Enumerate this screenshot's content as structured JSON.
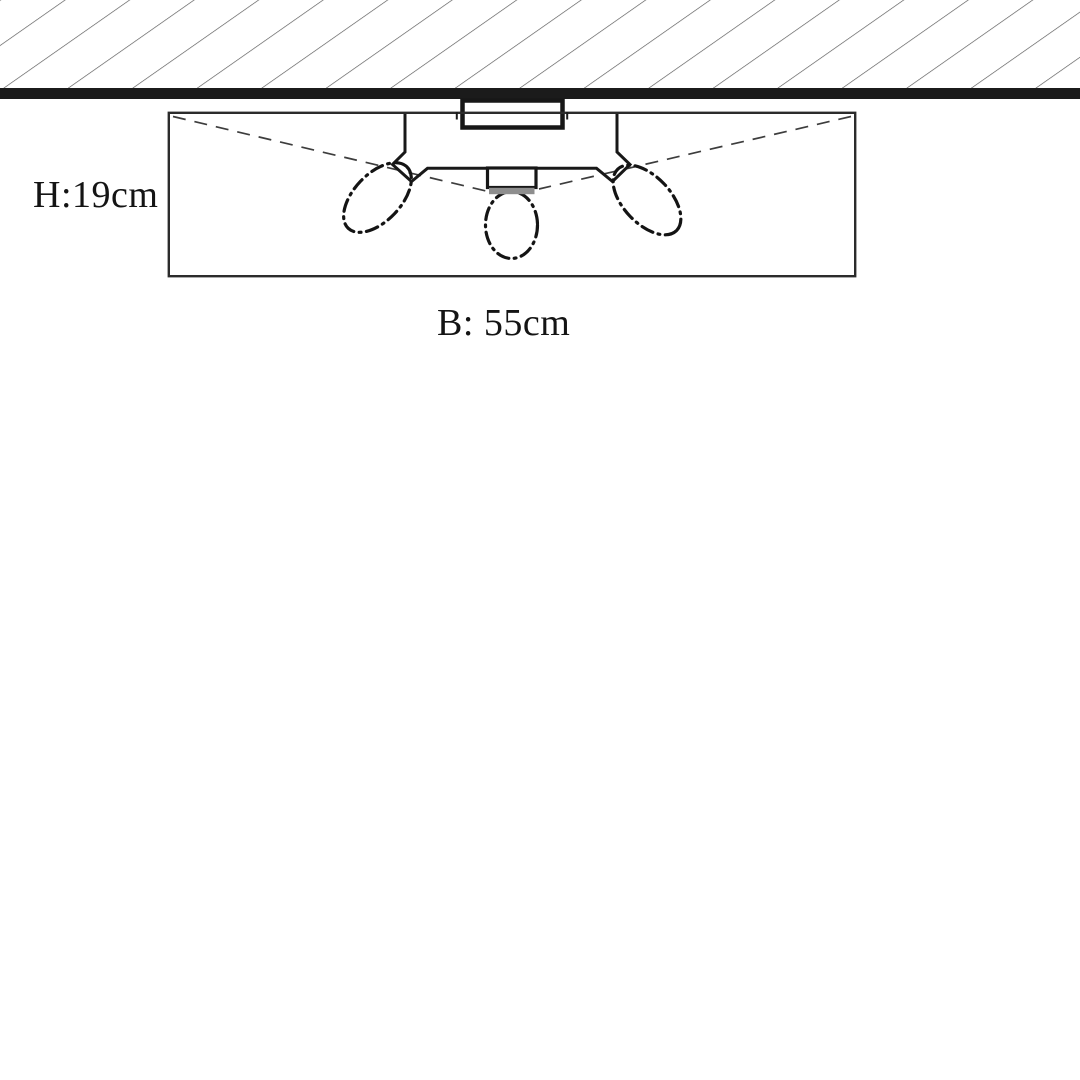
{
  "diagram": {
    "kind": "ceiling-lamp dimension drawing",
    "labels": {
      "height": "H:19cm",
      "width": "B: 55cm"
    },
    "colors": {
      "ink": "#181818",
      "ceiling_band": "#1b1b1b",
      "hatch_line": "#555555",
      "socket_shade": "#8e8e8e",
      "background": "#ffffff"
    }
  }
}
